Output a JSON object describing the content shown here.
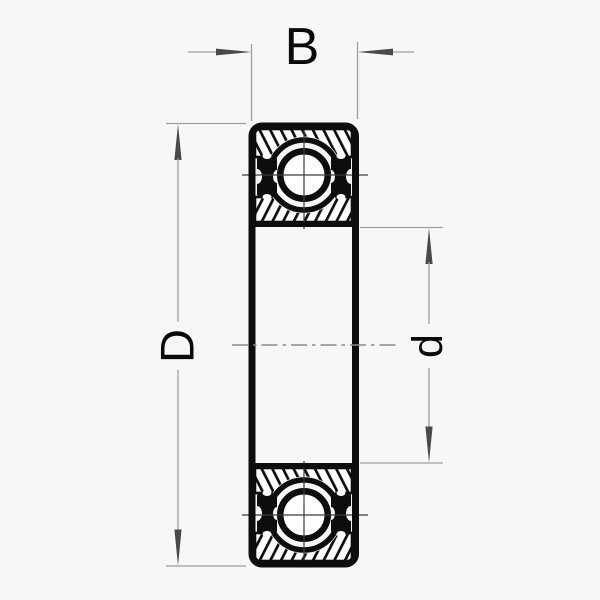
{
  "diagram": {
    "kind": "ball-bearing-cross-section-drawing",
    "labels": {
      "width": "B",
      "outer_diameter": "D",
      "bore_diameter": "d"
    }
  },
  "colors": {
    "background": "#f7f7f5",
    "drawing_line": "#0d0d0d",
    "dimension_line": "#9e9e9e",
    "arrowhead": "#4a4a4a",
    "label_text": "#0a0a0a",
    "centerline": "#8a8a8a"
  }
}
